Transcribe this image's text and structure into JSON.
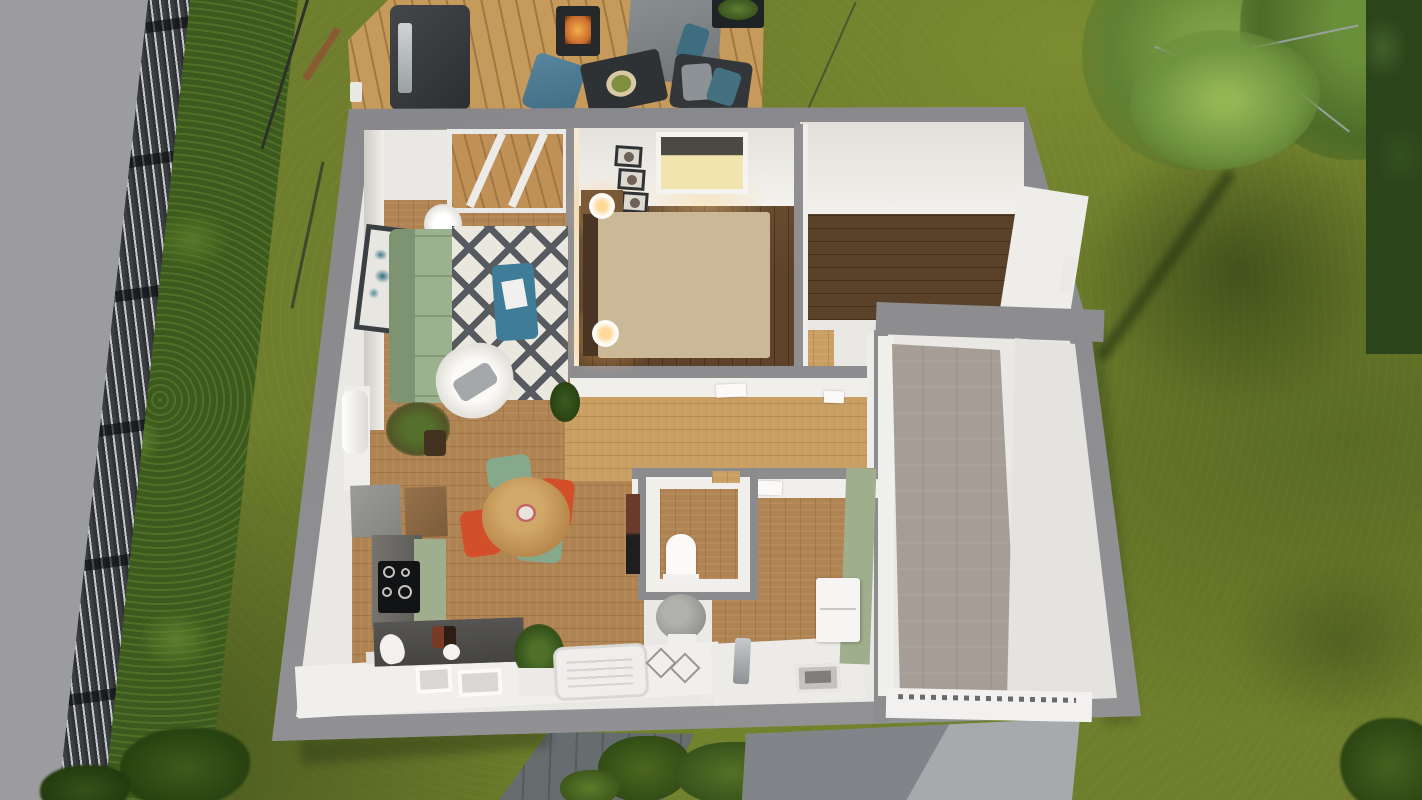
{
  "meta": {
    "description": "Bird's-eye 3D dollhouse rendering of a single-storey house floor plan, roof removed, set in a lawn with fence, hedges, wooden deck, trees, paved path and concrete driveway",
    "view": "top-down 3D architectural visualization",
    "visible_text": []
  },
  "colors": {
    "road": "#9c9c9e",
    "grass_base": "#6e7e2c",
    "hedge": "#3c5a1d",
    "deck_wood": "#c59a5b",
    "wall_outer": "#8b8b8e",
    "wall_inner": "#e9e8e5",
    "oak_floor": "#b08353",
    "oak_light": "#c99e63",
    "walnut_floor": "#5e4329",
    "concrete_garage": "#a79d97",
    "sage_green": "#9fae8c",
    "counter_dark": "#525150",
    "sofa_green": "#9cb28f",
    "rug_white": "#eae7df",
    "rug_dark": "#575b5f",
    "teal_accent": "#3e7c97",
    "chair_red": "#d34f2a",
    "chair_green": "#87a98b",
    "table_wood": "#c29456",
    "bed_duvet_dark": "#3b392c",
    "bed_beige": "#d9c9a8",
    "bed2_duvet_white": "#eaeae8",
    "driveway": "#a6aaad",
    "paver": "#62676a",
    "lamp_glow": "#ffd087",
    "fence_dark": "#3a3e41",
    "fence_light": "#c3c7c9",
    "tree_green": "#6a8f3a"
  },
  "exterior": {
    "regions": [
      {
        "name": "road",
        "side": "left"
      },
      {
        "name": "slatted-fence",
        "side": "left"
      },
      {
        "name": "hedge-row",
        "side": "left"
      },
      {
        "name": "lawn",
        "side": "all"
      },
      {
        "name": "wooden-deck",
        "side": "top"
      },
      {
        "name": "large-tree",
        "side": "top-right"
      },
      {
        "name": "hedge",
        "side": "right"
      },
      {
        "name": "paver-path",
        "side": "bottom"
      },
      {
        "name": "shrubs",
        "side": "bottom"
      },
      {
        "name": "concrete-driveway",
        "side": "bottom-right"
      }
    ],
    "deck_furniture": [
      "barbecue-grill",
      "fire-stove",
      "outdoor-sofa",
      "blue-lounge-chair",
      "outdoor-coffee-table",
      "cushioned-chair",
      "planter-box"
    ]
  },
  "house": {
    "rooms": [
      {
        "name": "living-room",
        "floor": "oak",
        "furniture": [
          "wall-art",
          "floor-lamp",
          "green-sofa",
          "diamond-pattern-rug",
          "teal-coffee-table",
          "white-armchair",
          "radiator",
          "potted-tree",
          "corner-plant"
        ]
      },
      {
        "name": "master-bedroom",
        "floor": "dark-walnut",
        "furniture": [
          "three-framed-pictures",
          "window-lit",
          "double-bed",
          "two-nightstands-with-lamps",
          "chevron-rug",
          "ladder-rack",
          "long-dresser"
        ]
      },
      {
        "name": "second-bedroom",
        "floor": "dark-walnut",
        "furniture": [
          "window",
          "white-double-bed",
          "zigzag-rug",
          "head-shelf",
          "folded-clothes"
        ]
      },
      {
        "name": "hallway",
        "floor": "oak",
        "furniture": [
          "open-doors"
        ]
      },
      {
        "name": "wc",
        "floor": "oak",
        "furniture": [
          "toilet",
          "dark-shelf"
        ]
      },
      {
        "name": "bathroom",
        "floor": "oak",
        "furniture": [
          "pedestal-sink",
          "bathtub",
          "pendant-wires",
          "vanity-cabinet",
          "shower-drain",
          "faucet"
        ],
        "wall_accent": "sage-green"
      },
      {
        "name": "kitchen-dining",
        "floor": "oak",
        "furniture": [
          "fridge",
          "brown-cabinet",
          "green-kitchen-counter",
          "black-cooktop",
          "sink-counter",
          "round-dining-table",
          "two-red-chairs",
          "two-green-chairs",
          "plant-in-planter"
        ]
      },
      {
        "name": "garage",
        "floor": "concrete",
        "furniture": [
          "garage-door"
        ]
      }
    ]
  }
}
